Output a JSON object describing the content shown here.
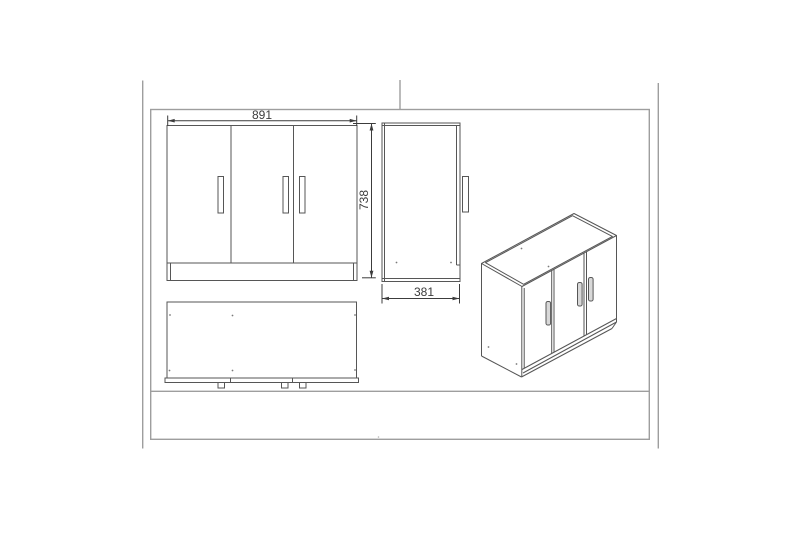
{
  "drawing": {
    "dimensions": {
      "width": "891",
      "height": "738",
      "depth": "381"
    }
  }
}
